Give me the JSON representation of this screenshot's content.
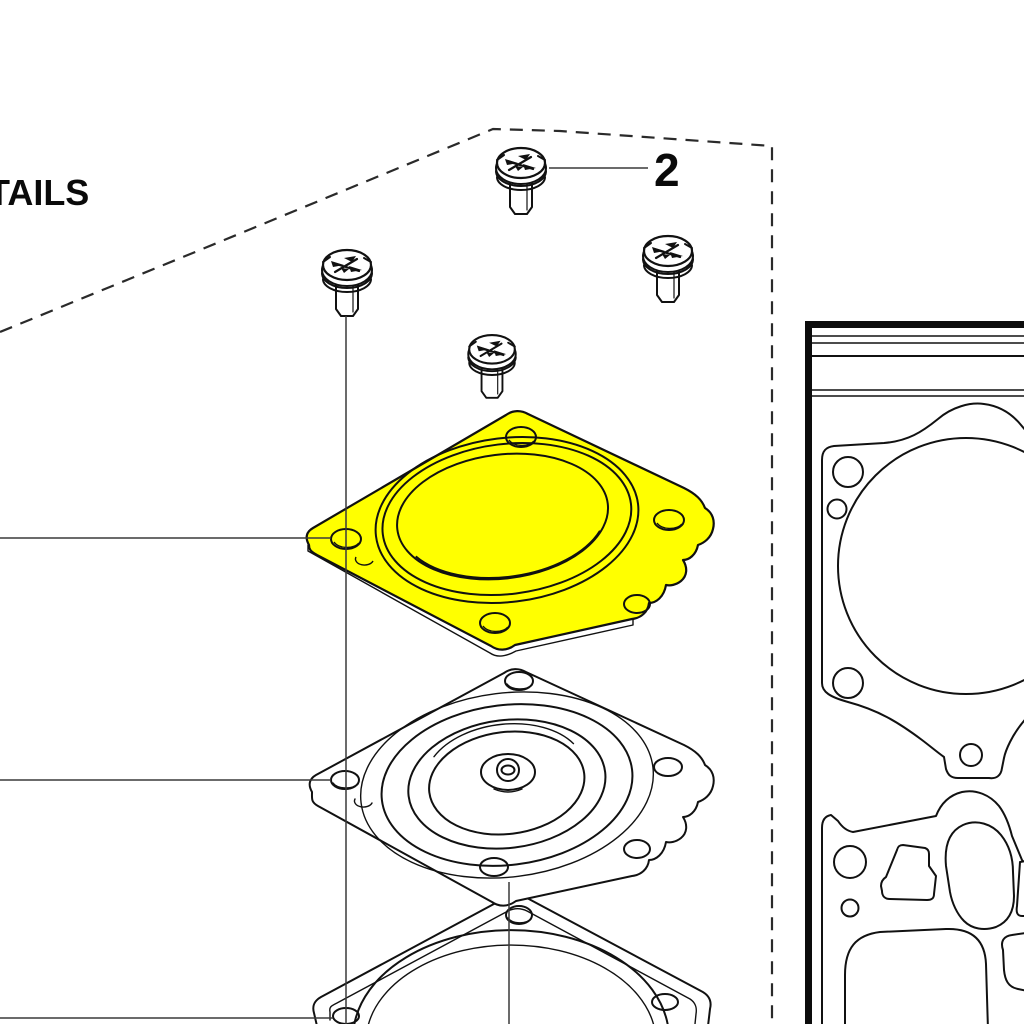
{
  "page": {
    "background": "#FFFFFF",
    "kind": "exploded-parts-diagram"
  },
  "title_fragment": "TAILS",
  "callout": {
    "label": "2"
  },
  "colors": {
    "highlight": "#FFFF00",
    "line": "#111111",
    "leader": "#3A3A3A"
  },
  "parts": {
    "screws": {
      "count": 4,
      "style": "phillips-pan-head-screw"
    },
    "highlighted_part": "diaphragm-cover",
    "middle_part": "metering-diaphragm",
    "bottom_part": "diaphragm-gasket",
    "inset_panel": {
      "gasket_count": 2
    }
  }
}
